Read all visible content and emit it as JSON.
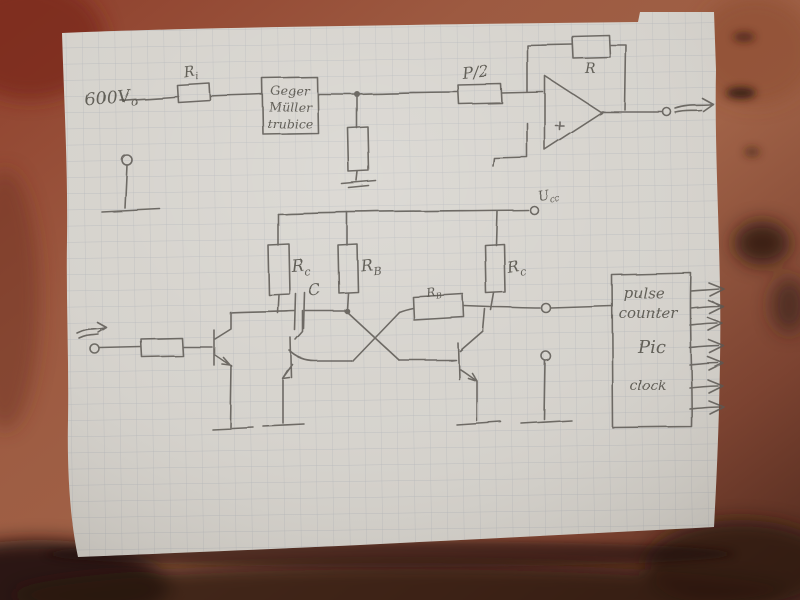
{
  "scene_title": "Hand-drawn Geiger counter schematic on squared paper",
  "colors": {
    "table": "#98543c",
    "table_dark": "#2a1710",
    "paper": "#d6d3cd",
    "grid": "#99a0aa",
    "pencil": "#5b5852",
    "ink": "#55524b"
  },
  "labels": {
    "supply": {
      "main": "600V",
      "sub": "o"
    },
    "r_input_top": {
      "main": "R",
      "sub": "i"
    },
    "geiger": {
      "line1": "Geger",
      "line2": "Müller",
      "line3": "trubice"
    },
    "pot": {
      "text": "P/2"
    },
    "feedback": {
      "text": "R"
    },
    "vcc": {
      "main": "U",
      "sub": "cc"
    },
    "rc_left": {
      "main": "R",
      "sub": "c"
    },
    "rb_pullup": {
      "main": "R",
      "sub": "B"
    },
    "rc_right": {
      "main": "R",
      "sub": "c"
    },
    "cap": {
      "text": "C"
    },
    "rb_coupling": {
      "main": "R",
      "sub": "B"
    },
    "counter": {
      "line1": "pulse",
      "line2": "counter",
      "line3": "Pic",
      "line4": "clock"
    }
  }
}
